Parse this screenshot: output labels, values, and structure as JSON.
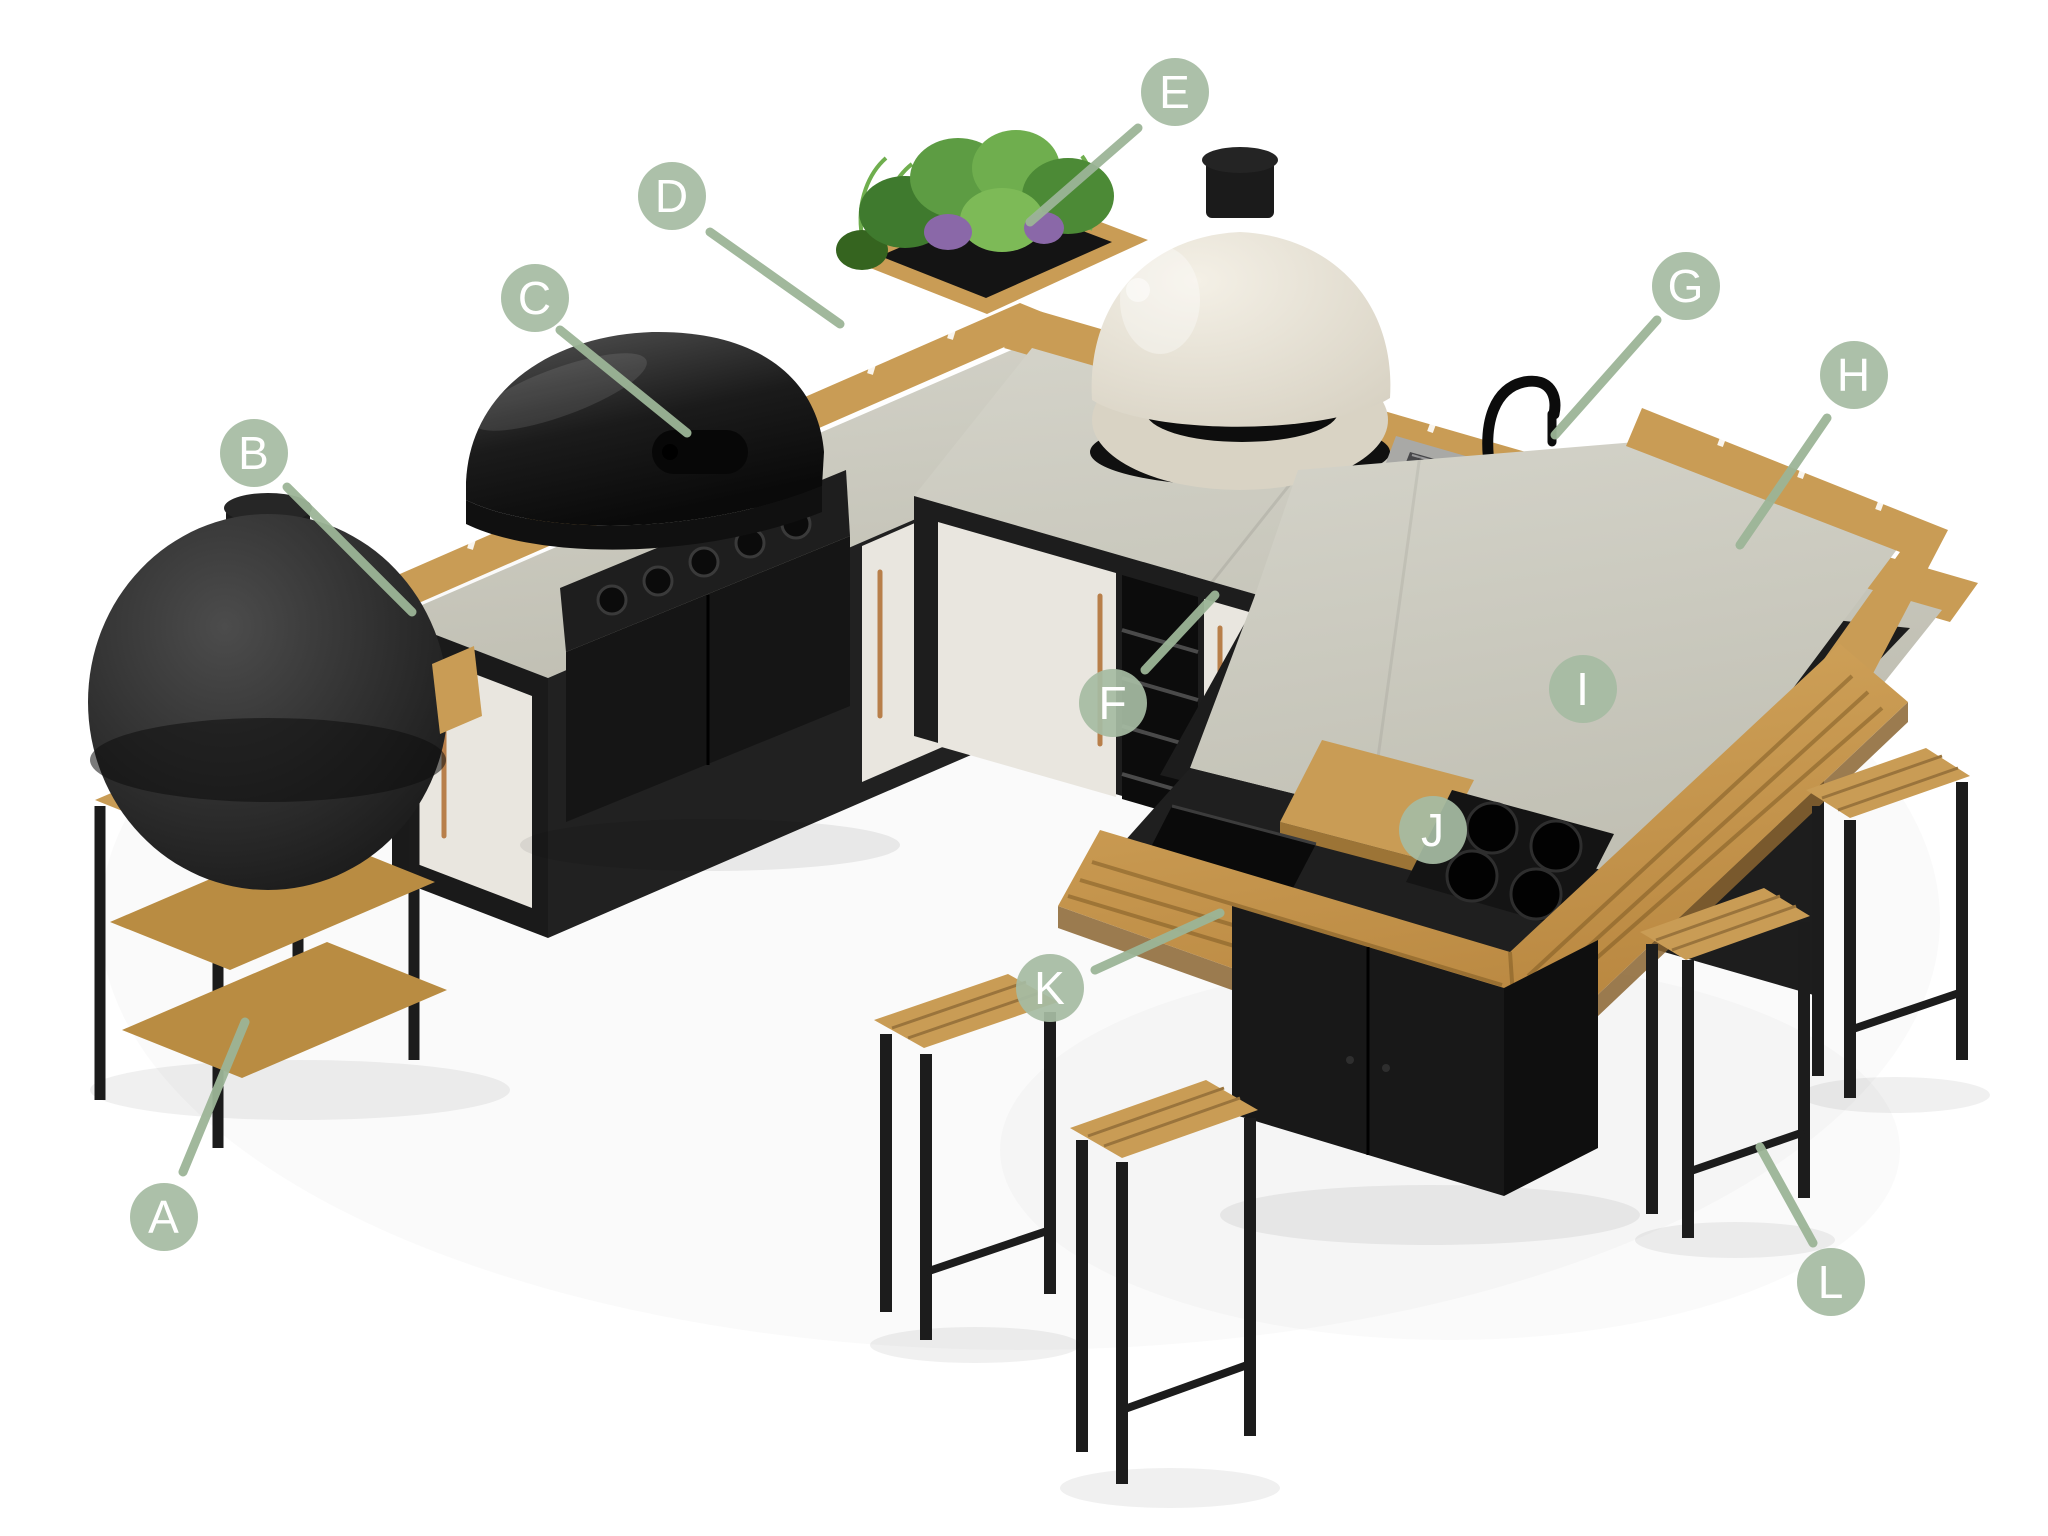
{
  "page": {
    "background": "#ffffff"
  },
  "palette": {
    "badge_fill": "#a6bba2",
    "badge_text": "#ffffff",
    "leader_line": "#9cb597",
    "wood": "#c99c55",
    "counter_grey": "#c9c8bd",
    "frame_dark": "#1e1e1e",
    "door_white": "#e9e6df",
    "oven_cream": "#eae5d9",
    "handle_copper": "#b87f4a",
    "plant_green": "#5d9c43"
  },
  "diagram": {
    "type": "labeled-product-diagram",
    "subject": "outdoor-kitchen-with-bar",
    "labels": [
      {
        "letter": "A",
        "x": 164,
        "y": 1217,
        "target": "side-shelf-table",
        "line": {
          "x1": 183,
          "y1": 1172,
          "x2": 245,
          "y2": 1022
        }
      },
      {
        "letter": "B",
        "x": 254,
        "y": 453,
        "target": "storage-cabinet",
        "line": {
          "x1": 287,
          "y1": 487,
          "x2": 412,
          "y2": 612
        }
      },
      {
        "letter": "C",
        "x": 535,
        "y": 298,
        "target": "gas-grill",
        "line": {
          "x1": 560,
          "y1": 330,
          "x2": 687,
          "y2": 433
        }
      },
      {
        "letter": "D",
        "x": 672,
        "y": 196,
        "target": "worktop-section",
        "line": {
          "x1": 710,
          "y1": 232,
          "x2": 840,
          "y2": 324
        }
      },
      {
        "letter": "E",
        "x": 1175,
        "y": 92,
        "target": "herb-planter",
        "line": {
          "x1": 1138,
          "y1": 128,
          "x2": 1030,
          "y2": 222
        }
      },
      {
        "letter": "F",
        "x": 1113,
        "y": 703,
        "target": "sliding-door-cabinet",
        "line": {
          "x1": 1145,
          "y1": 670,
          "x2": 1215,
          "y2": 595
        }
      },
      {
        "letter": "G",
        "x": 1686,
        "y": 286,
        "target": "sink-and-tap",
        "line": {
          "x1": 1657,
          "y1": 320,
          "x2": 1555,
          "y2": 435
        }
      },
      {
        "letter": "H",
        "x": 1854,
        "y": 375,
        "target": "corner-worktop",
        "line": {
          "x1": 1827,
          "y1": 418,
          "x2": 1740,
          "y2": 545
        }
      },
      {
        "letter": "I",
        "x": 1583,
        "y": 689,
        "target": "worktop",
        "line": null
      },
      {
        "letter": "J",
        "x": 1433,
        "y": 830,
        "target": "drinks-cooler-insert",
        "line": null
      },
      {
        "letter": "K",
        "x": 1050,
        "y": 988,
        "target": "bar-table",
        "line": {
          "x1": 1095,
          "y1": 970,
          "x2": 1220,
          "y2": 913
        }
      },
      {
        "letter": "L",
        "x": 1831,
        "y": 1282,
        "target": "bar-stool",
        "line": {
          "x1": 1813,
          "y1": 1243,
          "x2": 1760,
          "y2": 1147
        }
      }
    ]
  }
}
